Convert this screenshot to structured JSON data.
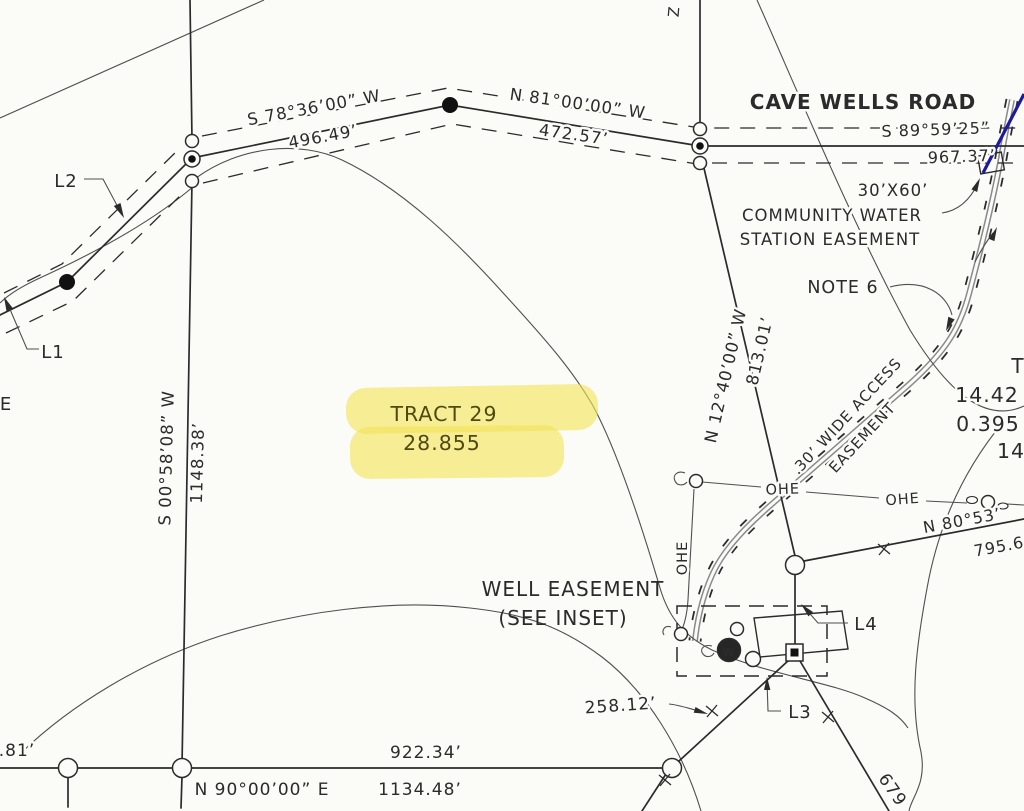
{
  "palette": {
    "paper": "#fbfbf8",
    "ink": "#2b2b2b",
    "easement_gray": "#8a8a8a",
    "highlight_yellow": "#f2e458",
    "blue_line": "#1d1a9e"
  },
  "road": {
    "name": "CAVE WELLS ROAD",
    "bearing": "S 89°59’25”",
    "distance": "967.37’"
  },
  "north_boundary": {
    "seg1": {
      "bearing": "S 78°36’00” W",
      "distance": "496.49’"
    },
    "seg2": {
      "bearing": "N 81°00’00” W",
      "distance": "472.57’"
    }
  },
  "west_boundary": {
    "bearing": "S 00°58’08” W",
    "distance": "1148.38’"
  },
  "south_boundary": {
    "bearing": "N 90°00’00” E",
    "distance": "1134.48’",
    "left_dim": "922.34’",
    "cut_dim": ".81’"
  },
  "northeast_boundary": {
    "bearing": "N 12°40’00” W",
    "distance": "813.01’"
  },
  "southeast_line": {
    "bearing": "N 80°53’",
    "distance": "795.6"
  },
  "tract": {
    "name": "TRACT 29",
    "acreage": "28.855"
  },
  "water_station": {
    "size": "30’X60’",
    "line1": "COMMUNITY WATER",
    "line2": "STATION EASEMENT",
    "note": "NOTE 6"
  },
  "access_easement": {
    "line1": "30’ WIDE ACCESS",
    "line2": "EASEMENT"
  },
  "well_easement": {
    "line1": "WELL EASEMENT",
    "line2": "(SEE INSET)",
    "dim": "258.12’",
    "diag_dim": "679",
    "well_letter": "W"
  },
  "line_refs": {
    "l1": "L1",
    "l2": "L2",
    "l3": "L3",
    "l4": "L4"
  },
  "utility": {
    "ohe": "OHE"
  },
  "edge_partials": {
    "right_title": "T",
    "right_val1": "14.42",
    "right_val2": "0.395",
    "right_val3": "14",
    "left_letter": "E",
    "top_letter": "Z"
  }
}
